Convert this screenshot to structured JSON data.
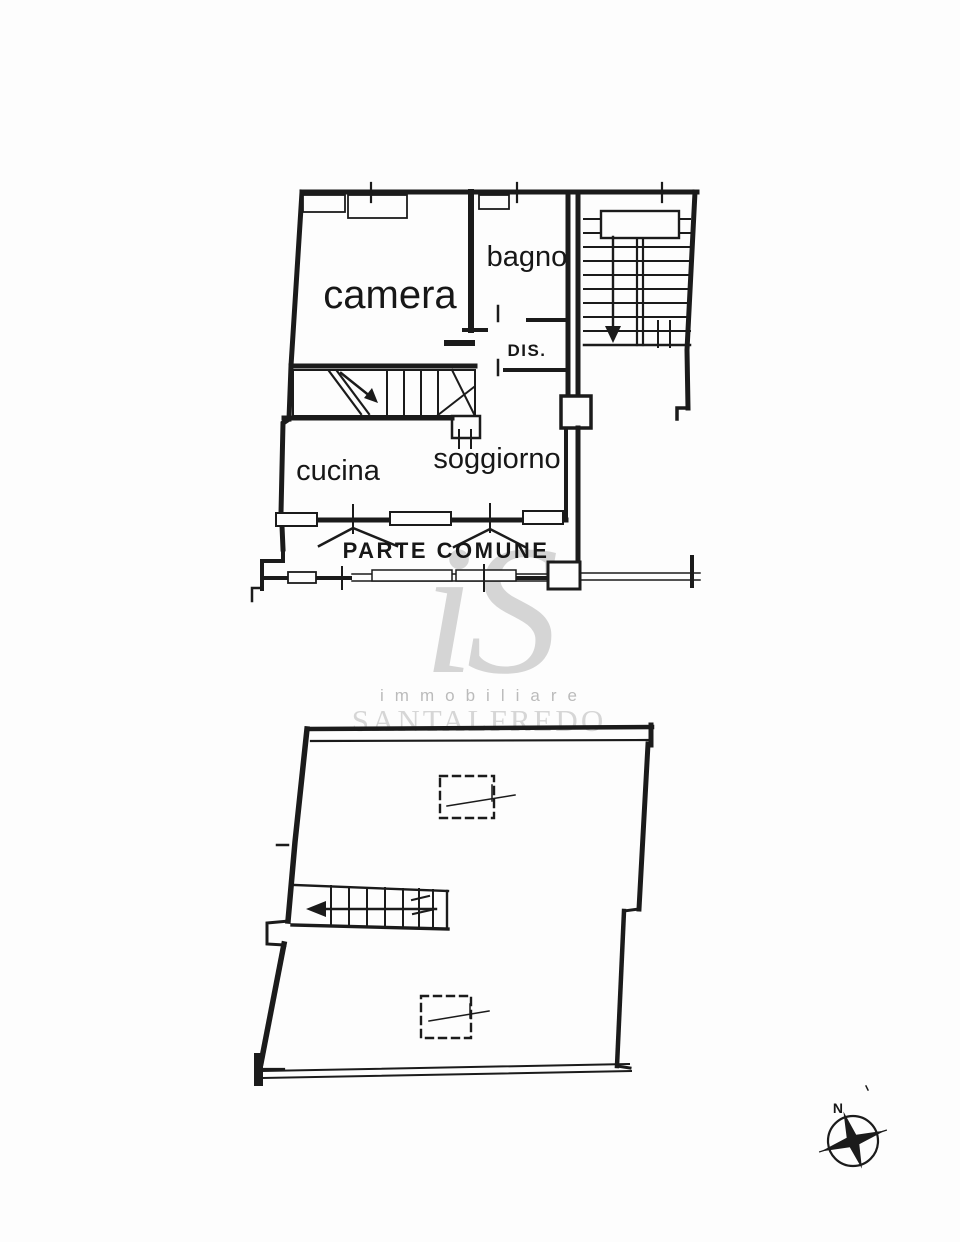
{
  "document": {
    "type": "real-estate floor plan scan",
    "background": "#fdfdfd",
    "ink": "#1b1b1b"
  },
  "upper_floor": {
    "rooms": [
      {
        "name": "camera"
      },
      {
        "name": "bagno"
      },
      {
        "name": "DIS."
      },
      {
        "name": "cucina"
      },
      {
        "name": "soggiorno"
      }
    ],
    "common_area": "PARTE COMUNE"
  },
  "lower_floor": {
    "features": [
      "staircase",
      "skylight-upper",
      "skylight-lower"
    ]
  },
  "watermark": {
    "monogram": "iS",
    "subtitle": "immobiliare",
    "brand": "SANTALFREDO",
    "monogram_color": "#c6c6c6",
    "subtitle_color": "#b0b0b0",
    "brand_color": "#d4d4d4"
  },
  "compass": {
    "north": "N"
  }
}
